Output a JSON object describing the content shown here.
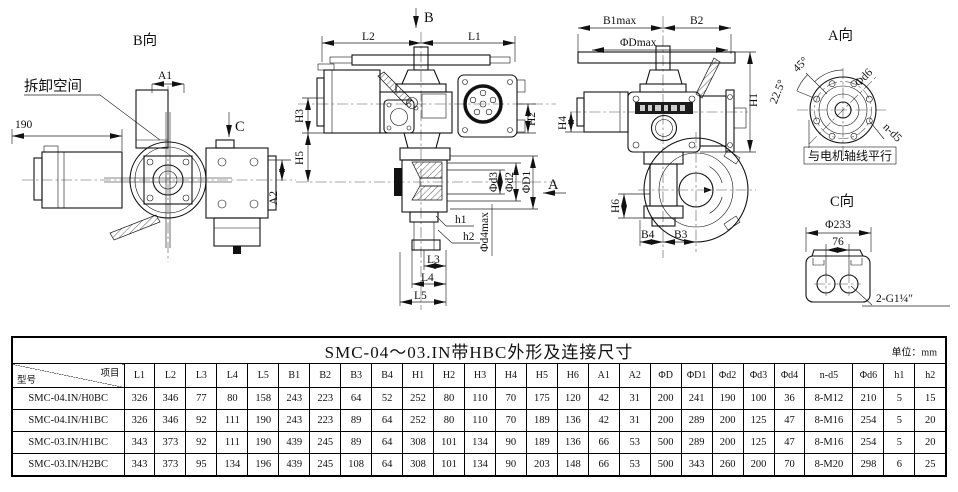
{
  "drawing": {
    "view_b": {
      "title": "B向",
      "removal_space_label": "拆卸空间",
      "dim_190": "190",
      "a1": "A1",
      "c": "C",
      "a2": "A2"
    },
    "front": {
      "b": "B",
      "l2": "L2",
      "l1": "L1",
      "h3": "H3",
      "h5": "H5",
      "h2": "H2",
      "d3": "Φd3",
      "d2": "Φd2",
      "dd1": "ΦD1",
      "a": "A",
      "h1s": "h1",
      "h2s": "h2",
      "d4max": "Φd4max",
      "l3": "L3",
      "l4": "L4",
      "l5": "L5"
    },
    "right": {
      "b1max": "B1max",
      "b2": "B2",
      "dmax": "ΦDmax",
      "h1": "H1",
      "h4": "H4",
      "h6": "H6",
      "b4": "B4",
      "b3": "B3"
    },
    "view_a": {
      "title": "A向",
      "angle45": "45°",
      "angle225": "22.5°",
      "d6": "Φd6",
      "nd5": "n-d5",
      "note": "与电机轴线平行"
    },
    "view_c": {
      "title": "C向",
      "d233": "Φ233",
      "s76": "76",
      "thread": "2-G1¼″"
    }
  },
  "table": {
    "title": "SMC-04～03.IN带HBC外形及连接尺寸",
    "unit_label": "单位：mm",
    "corner": {
      "top": "项目",
      "bottom": "型号"
    },
    "columns": [
      "L1",
      "L2",
      "L3",
      "L4",
      "L5",
      "B1",
      "B2",
      "B3",
      "B4",
      "H1",
      "H2",
      "H3",
      "H4",
      "H5",
      "H6",
      "A1",
      "A2",
      "ΦD",
      "ΦD1",
      "Φd2",
      "Φd3",
      "Φd4",
      "n-d5",
      "Φd6",
      "h1",
      "h2"
    ],
    "rows": [
      {
        "model": "SMC-04.IN/H0BC",
        "values": [
          "326",
          "346",
          "77",
          "80",
          "158",
          "243",
          "223",
          "64",
          "52",
          "252",
          "80",
          "110",
          "70",
          "175",
          "120",
          "42",
          "31",
          "200",
          "241",
          "190",
          "100",
          "36",
          "8-M12",
          "210",
          "5",
          "15"
        ]
      },
      {
        "model": "SMC-04.IN/H1BC",
        "values": [
          "326",
          "346",
          "92",
          "111",
          "190",
          "243",
          "223",
          "89",
          "64",
          "252",
          "80",
          "110",
          "70",
          "189",
          "136",
          "42",
          "31",
          "200",
          "289",
          "200",
          "125",
          "47",
          "8-M16",
          "254",
          "5",
          "20"
        ]
      },
      {
        "model": "SMC-03.IN/H1BC",
        "values": [
          "343",
          "373",
          "92",
          "111",
          "190",
          "439",
          "245",
          "89",
          "64",
          "308",
          "101",
          "134",
          "90",
          "189",
          "136",
          "66",
          "53",
          "500",
          "289",
          "200",
          "125",
          "47",
          "8-M16",
          "254",
          "5",
          "20"
        ]
      },
      {
        "model": "SMC-03.IN/H2BC",
        "values": [
          "343",
          "373",
          "95",
          "134",
          "196",
          "439",
          "245",
          "108",
          "64",
          "308",
          "101",
          "134",
          "90",
          "203",
          "148",
          "66",
          "53",
          "500",
          "343",
          "260",
          "200",
          "70",
          "8-M20",
          "298",
          "6",
          "25"
        ]
      }
    ]
  }
}
